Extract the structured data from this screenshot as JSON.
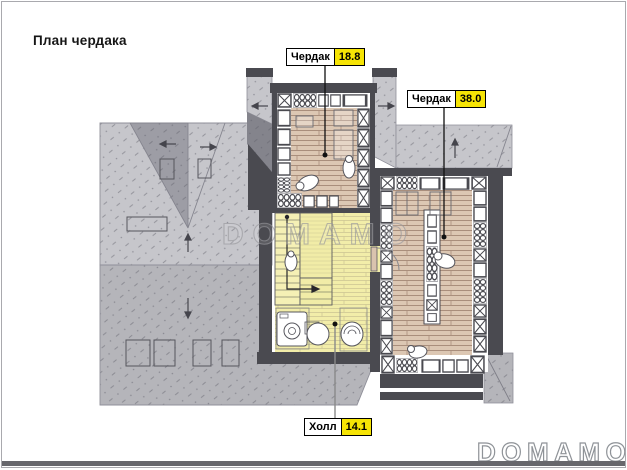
{
  "page": {
    "title": "План чердака"
  },
  "labels": [
    {
      "name": "Чердак",
      "value": "18.8"
    },
    {
      "name": "Чердак",
      "value": "38.0"
    },
    {
      "name": "Холл",
      "value": "14.1"
    }
  ],
  "watermark": {
    "text": "DOMAMO"
  },
  "brand": {
    "text": "DOMAMO"
  },
  "colors": {
    "area_value_highlight": "#f6e405",
    "roof_light": "#c6c6cb",
    "roof_dark": "#b5b5ba",
    "roof_valley": "#9d9da5",
    "wall": "#4a4a50",
    "wood_floor": "#dcc7b3",
    "hall_floor": "#f2eda9",
    "page_border": "#a9a9ae"
  }
}
